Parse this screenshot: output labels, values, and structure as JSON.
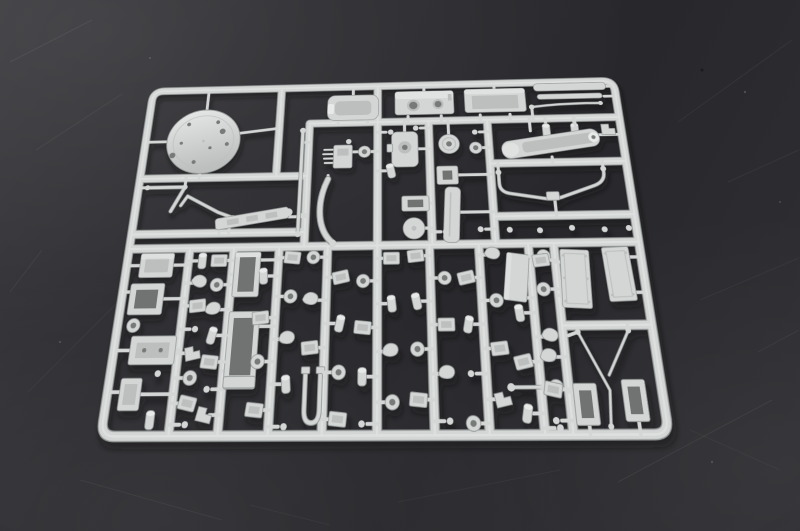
{
  "scene": {
    "type": "photograph",
    "description": "Light grey injection-moulded plastic model kit sprue (parts tree) holding dozens of small scale-model parts, photographed at a slight angle on a dark matte grey surface with faint scratches",
    "background_surface": "dark matte grey with faint diagonal scratches",
    "object": "styrene model kit runner with attached parts",
    "visible_text": ""
  },
  "colors": {
    "background-base": "#28282c",
    "background-light": "#3a3a3e",
    "plastic": "#d3d6d5",
    "plastic-light": "#e8eae9",
    "plastic-mid": "#bcbfbe",
    "plastic-dark": "#949897",
    "plastic-hole": "#777a79",
    "cavity": "#6f7372",
    "shadow": "#08080a",
    "scratch": "#ffffff"
  },
  "sprue": {
    "material_color_name": "light grey styrene",
    "corner_style": "rounded rectangle frame",
    "notable_parts": "large circular turret-ring disc, stowage boxes, open bins, trough and barrel sections, anti-roll bar, aerial rods, hull plates, grab handle, many small fittings"
  }
}
